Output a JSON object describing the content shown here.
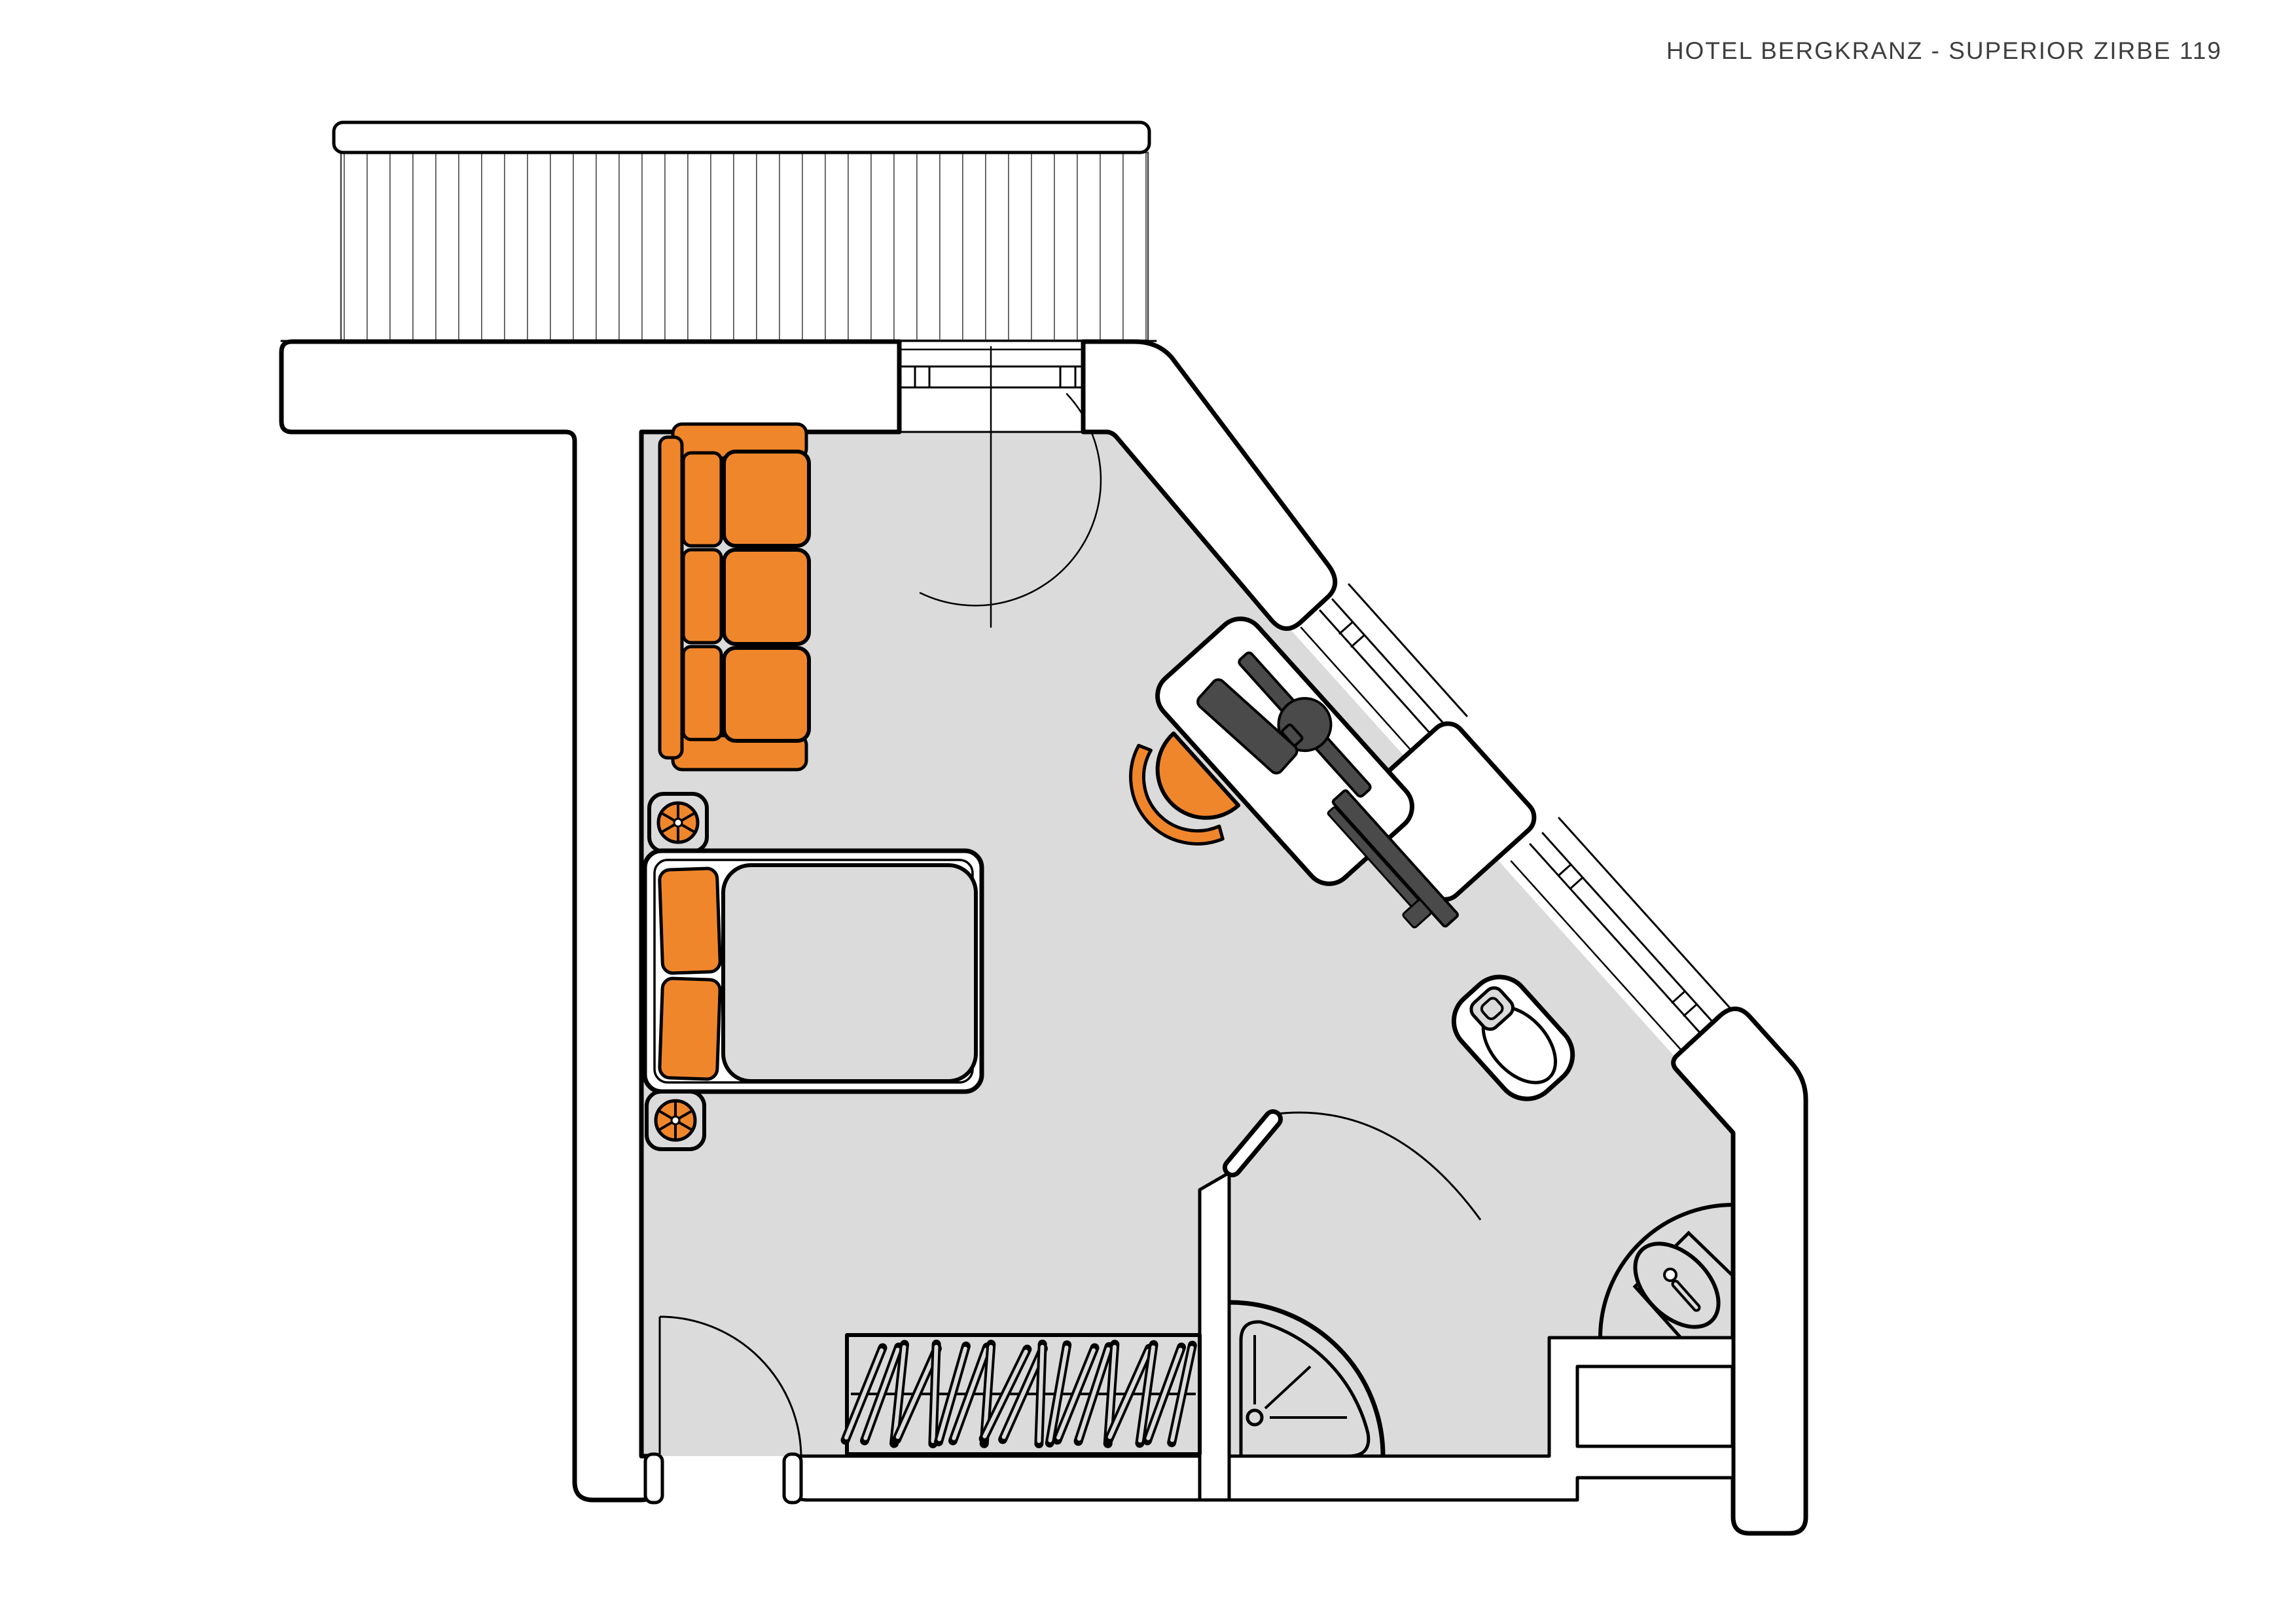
{
  "header": {
    "title": "HOTEL BERGKRANZ - SUPERIOR ZIRBE 119",
    "hotel_name": "HOTEL BERGKRANZ",
    "room_name": "SUPERIOR ZIRBE 119"
  },
  "colors": {
    "background": "#ffffff",
    "floor": "#dbdbdb",
    "outline": "#000000",
    "accent_orange": "#f0862b",
    "furniture_dark": "#4a4a4a",
    "deck_line": "#555555",
    "title_text": "#3f3f3f"
  },
  "icons": [
    {
      "name": "ceiling-lamp-icon",
      "glyph": "spoked-circle"
    },
    {
      "name": "shower-drain-icon",
      "glyph": "circle-with-rays"
    },
    {
      "name": "tap-icon",
      "glyph": "dot-with-handle"
    },
    {
      "name": "hanger-icon",
      "glyph": "slanted-loop"
    }
  ],
  "furniture_counts": {
    "sofa_seat_cushions": 3,
    "bed_pillows": 2,
    "nightstand_lamps": 2,
    "wardrobe_hangers": 19,
    "window_sections_diagonal": 2
  }
}
